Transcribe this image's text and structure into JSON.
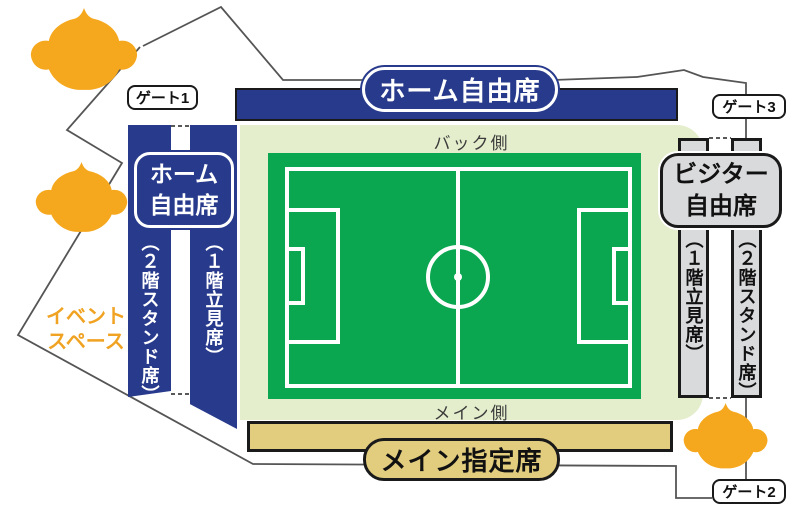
{
  "stadium": {
    "top_stand": {
      "banner": "ホーム自由席"
    },
    "left_stand": {
      "pill_line1": "ホーム",
      "pill_line2": "自由席",
      "outer_column": "（２階スタンド席）",
      "inner_column": "（１階立見席）"
    },
    "right_stand": {
      "pill_line1": "ビジター",
      "pill_line2": "自由席",
      "inner_column": "（１階立見席）",
      "outer_column": "（２階スタンド席）"
    },
    "bottom_stand": {
      "bar_label": "メイン指定席"
    },
    "field": {
      "back_side": "バック側",
      "main_side": "メイン側"
    },
    "gates": {
      "gate1": "ゲート1",
      "gate2": "ゲート2",
      "gate3": "ゲート3"
    },
    "event_space": {
      "line1": "イベント",
      "line2": "スペース"
    }
  },
  "colors": {
    "home_navy": "#283a8c",
    "field_green": "#0aa750",
    "concourse_pale": "#e4eecd",
    "main_tan": "#e2cd7e",
    "visitor_gray": "#d9dadc",
    "mascot_orange": "#f5a81e",
    "event_space_orange": "#f0a322",
    "outline_black": "#1a1a1a"
  },
  "icons": {
    "mascot": "club-mascot-silhouette"
  }
}
